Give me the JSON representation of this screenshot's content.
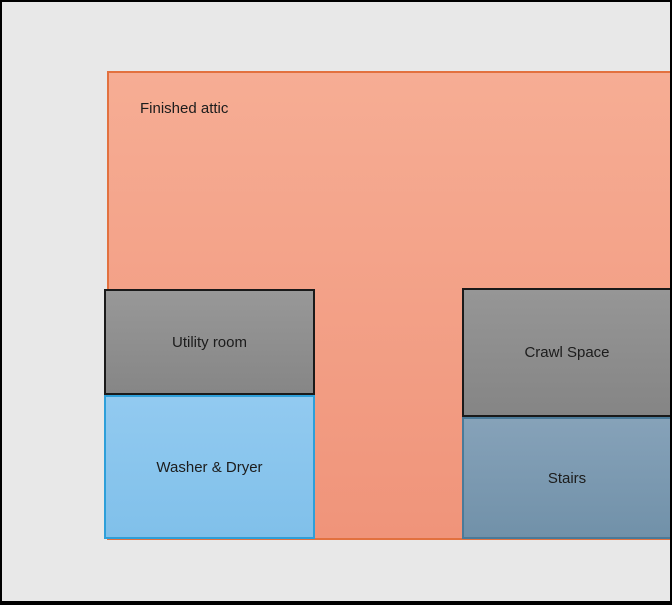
{
  "diagram": {
    "type": "floor-plan",
    "background_color": "#e8e8e8",
    "frame_color": "#000000",
    "rooms": [
      {
        "id": "finished-attic",
        "label": "Finished attic",
        "fill_top": "#f6ad94",
        "fill_bottom": "#f0947a",
        "border_color": "#e2713f",
        "label_position": "top-left"
      },
      {
        "id": "utility-room",
        "label": "Utility room",
        "fill_top": "#989898",
        "fill_bottom": "#868686",
        "border_color": "#1a1a1a",
        "label_position": "center"
      },
      {
        "id": "washer-dryer",
        "label": "Washer & Dryer",
        "fill_top": "#92caf0",
        "fill_bottom": "#80c0ea",
        "border_color": "#2e9fd9",
        "label_position": "center"
      },
      {
        "id": "crawl-space",
        "label": "Crawl Space",
        "fill_top": "#969696",
        "fill_bottom": "#858585",
        "border_color": "#1a1a1a",
        "label_position": "center"
      },
      {
        "id": "stairs",
        "label": "Stairs",
        "fill_top": "#86a2b9",
        "fill_bottom": "#7191a9",
        "border_color": "#4a7a99",
        "label_position": "center"
      }
    ],
    "text_color": "#1c1c1c"
  }
}
